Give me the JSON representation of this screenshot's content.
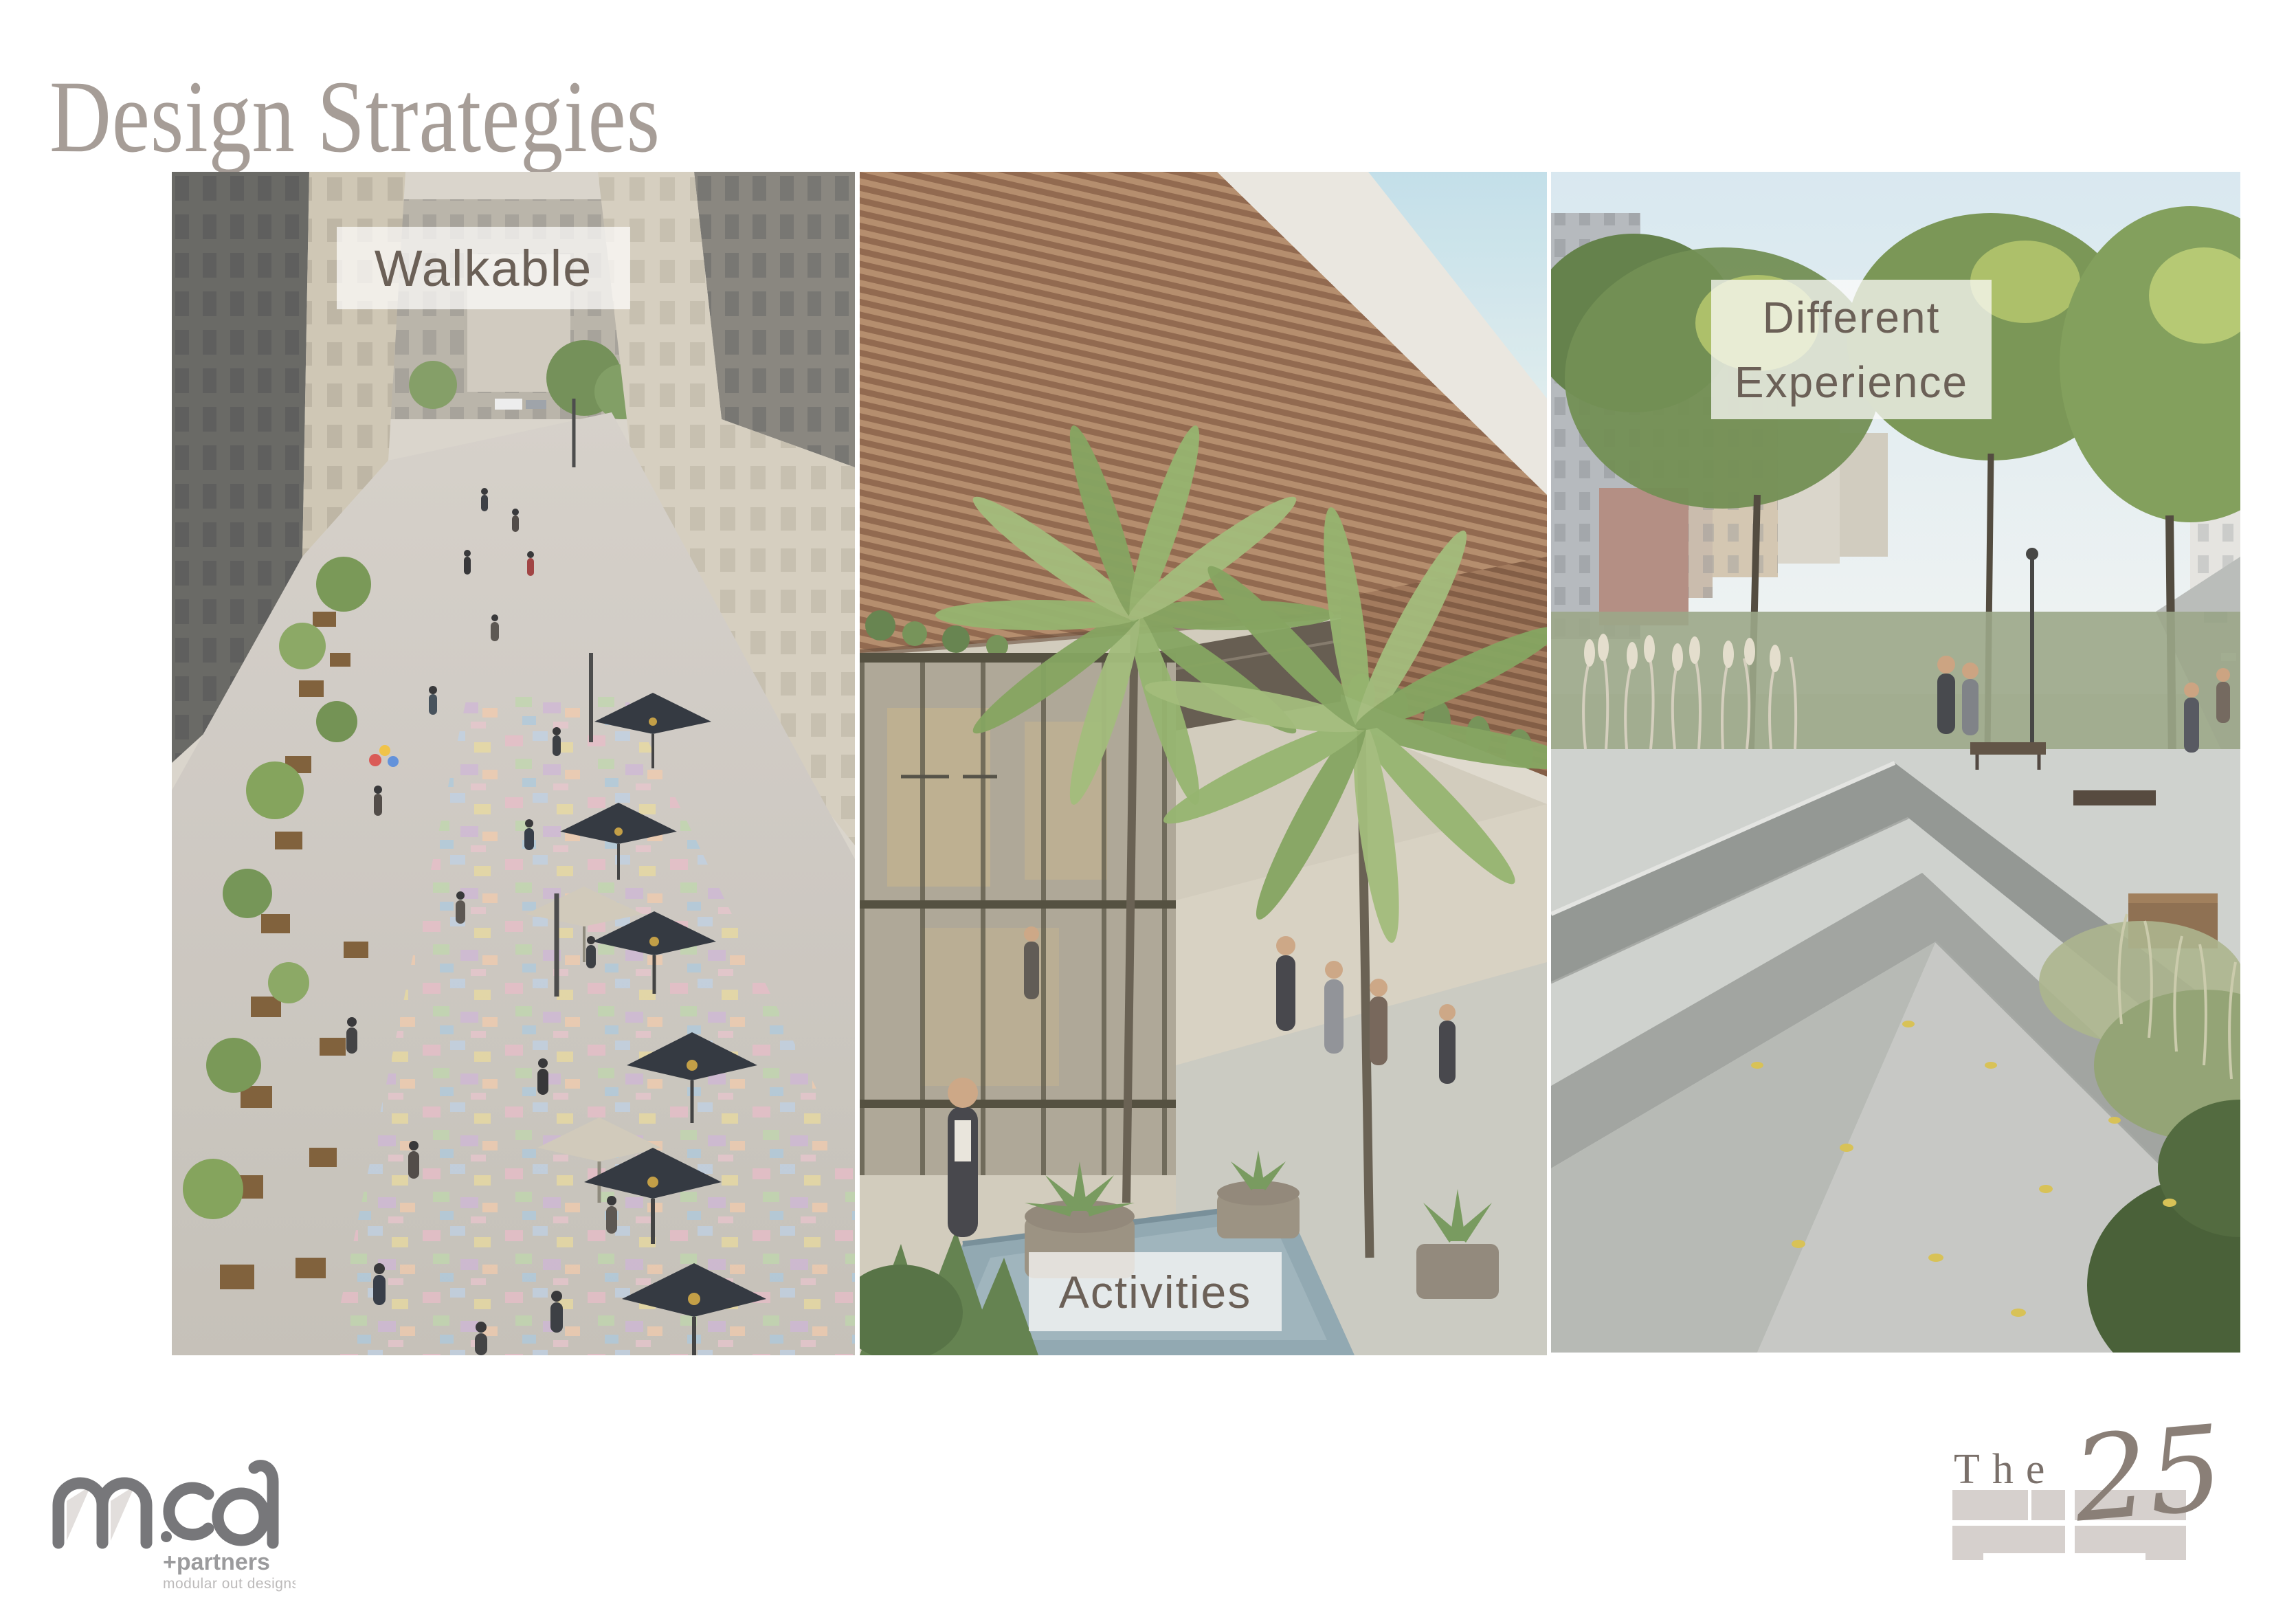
{
  "slide": {
    "title": "Design Strategies"
  },
  "panels": [
    {
      "name": "walkable",
      "label": "Walkable",
      "image": "pedestrian-shopping-street-aerial-photo"
    },
    {
      "name": "activities",
      "label": "Activities",
      "image": "palm-courtyard-plaza-rendering"
    },
    {
      "name": "different-experience",
      "label_line1": "Different",
      "label_line2": "Experience",
      "image": "linear-park-walkway-rendering"
    }
  ],
  "branding": {
    "mcd": {
      "wordmark": "mcd",
      "partners": "+partners",
      "tagline": "modular out designs"
    },
    "the25": {
      "word": "The",
      "number": "25"
    }
  },
  "colors": {
    "title": "#a69d97",
    "label_text": "#6b6057",
    "label_background": "rgba(252,251,249,0.74)",
    "brick": "#d6d0cd",
    "mcd_gray": "#77777a",
    "partners_gray": "#9b9b9d",
    "tagline_gray": "#bcbaba",
    "the25_taupe": "#7a706a",
    "the25_number": "#8a7f77"
  }
}
